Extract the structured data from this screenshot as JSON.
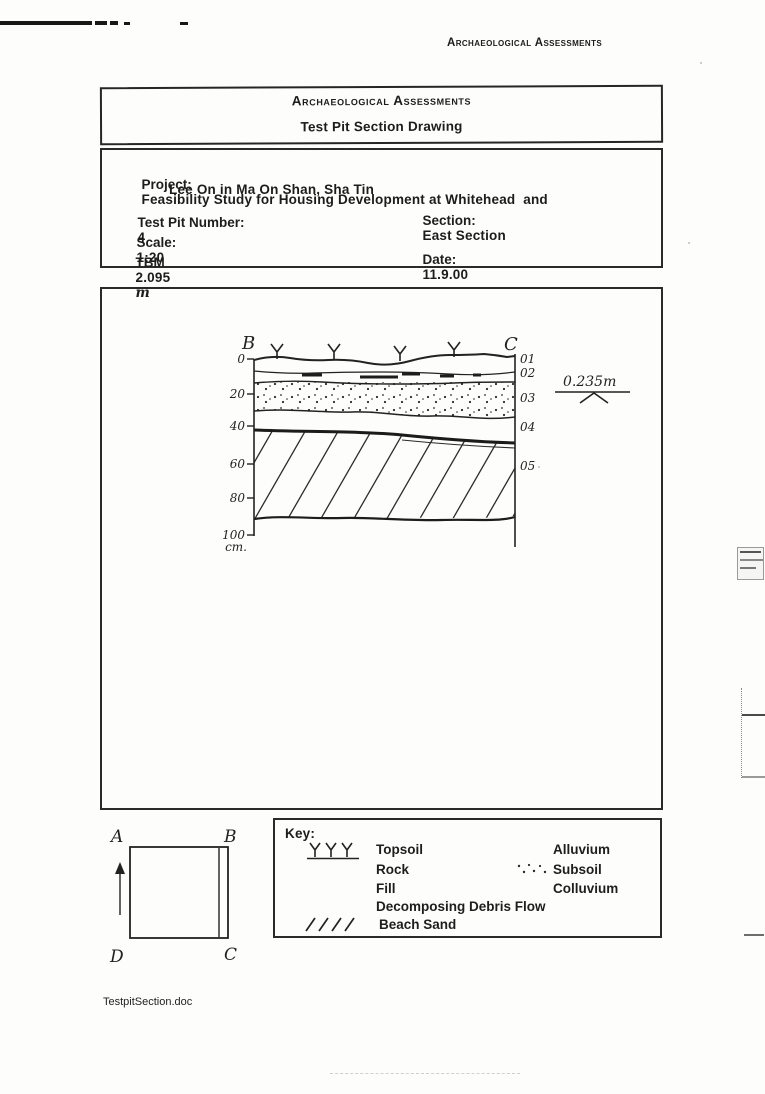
{
  "page": {
    "header_right": "Archaeological Assessments",
    "footer": "TestpitSection.doc"
  },
  "colors": {
    "ink": "#1e1e1e",
    "paper": "#fdfdfb"
  },
  "title_box": {
    "line1": "Archaeological Assessments",
    "line2": "Test Pit Section Drawing"
  },
  "info_box": {
    "project_label": "Project:",
    "project_line1": "Feasibility Study for Housing Development at Whitehead  and",
    "project_line2": "Lee On in Ma On Shan, Sha Tin",
    "test_pit_label": "Test Pit Number:",
    "test_pit_value": "4",
    "scale_label": "Scale:",
    "scale_value": "1:20",
    "tbm_label": "TBM",
    "tbm_value": "2.095",
    "tbm_unit": "m",
    "section_label": "Section:",
    "section_value": "East Section",
    "date_label": "Date:",
    "date_value": "11.9.00"
  },
  "section_drawing": {
    "left_end_label": "B",
    "right_end_label": "C",
    "depth_ticks": [
      "0",
      "20",
      "40",
      "60",
      "80",
      "100"
    ],
    "depth_unit": "cm.",
    "layer_labels": [
      "01",
      "02",
      "03",
      "04",
      "05"
    ],
    "level_annotation": "0.235m"
  },
  "key_box": {
    "title": "Key:",
    "left": [
      {
        "symbol": "topsoil-grass",
        "label": "Topsoil"
      },
      {
        "symbol": "",
        "label": "Rock"
      },
      {
        "symbol": "",
        "label": "Fill"
      },
      {
        "symbol": "",
        "label": "Decomposing Debris Flow"
      },
      {
        "symbol": "beach-sand-slashes",
        "label": "Beach Sand"
      }
    ],
    "right": [
      {
        "symbol": "",
        "label": "Alluvium"
      },
      {
        "symbol": "subsoil-dots",
        "label": "Subsoil"
      },
      {
        "symbol": "",
        "label": "Colluvium"
      }
    ]
  },
  "plan": {
    "corner_top_left": "A",
    "corner_top_right": "B",
    "corner_bottom_right": "C",
    "corner_bottom_left": "D"
  }
}
